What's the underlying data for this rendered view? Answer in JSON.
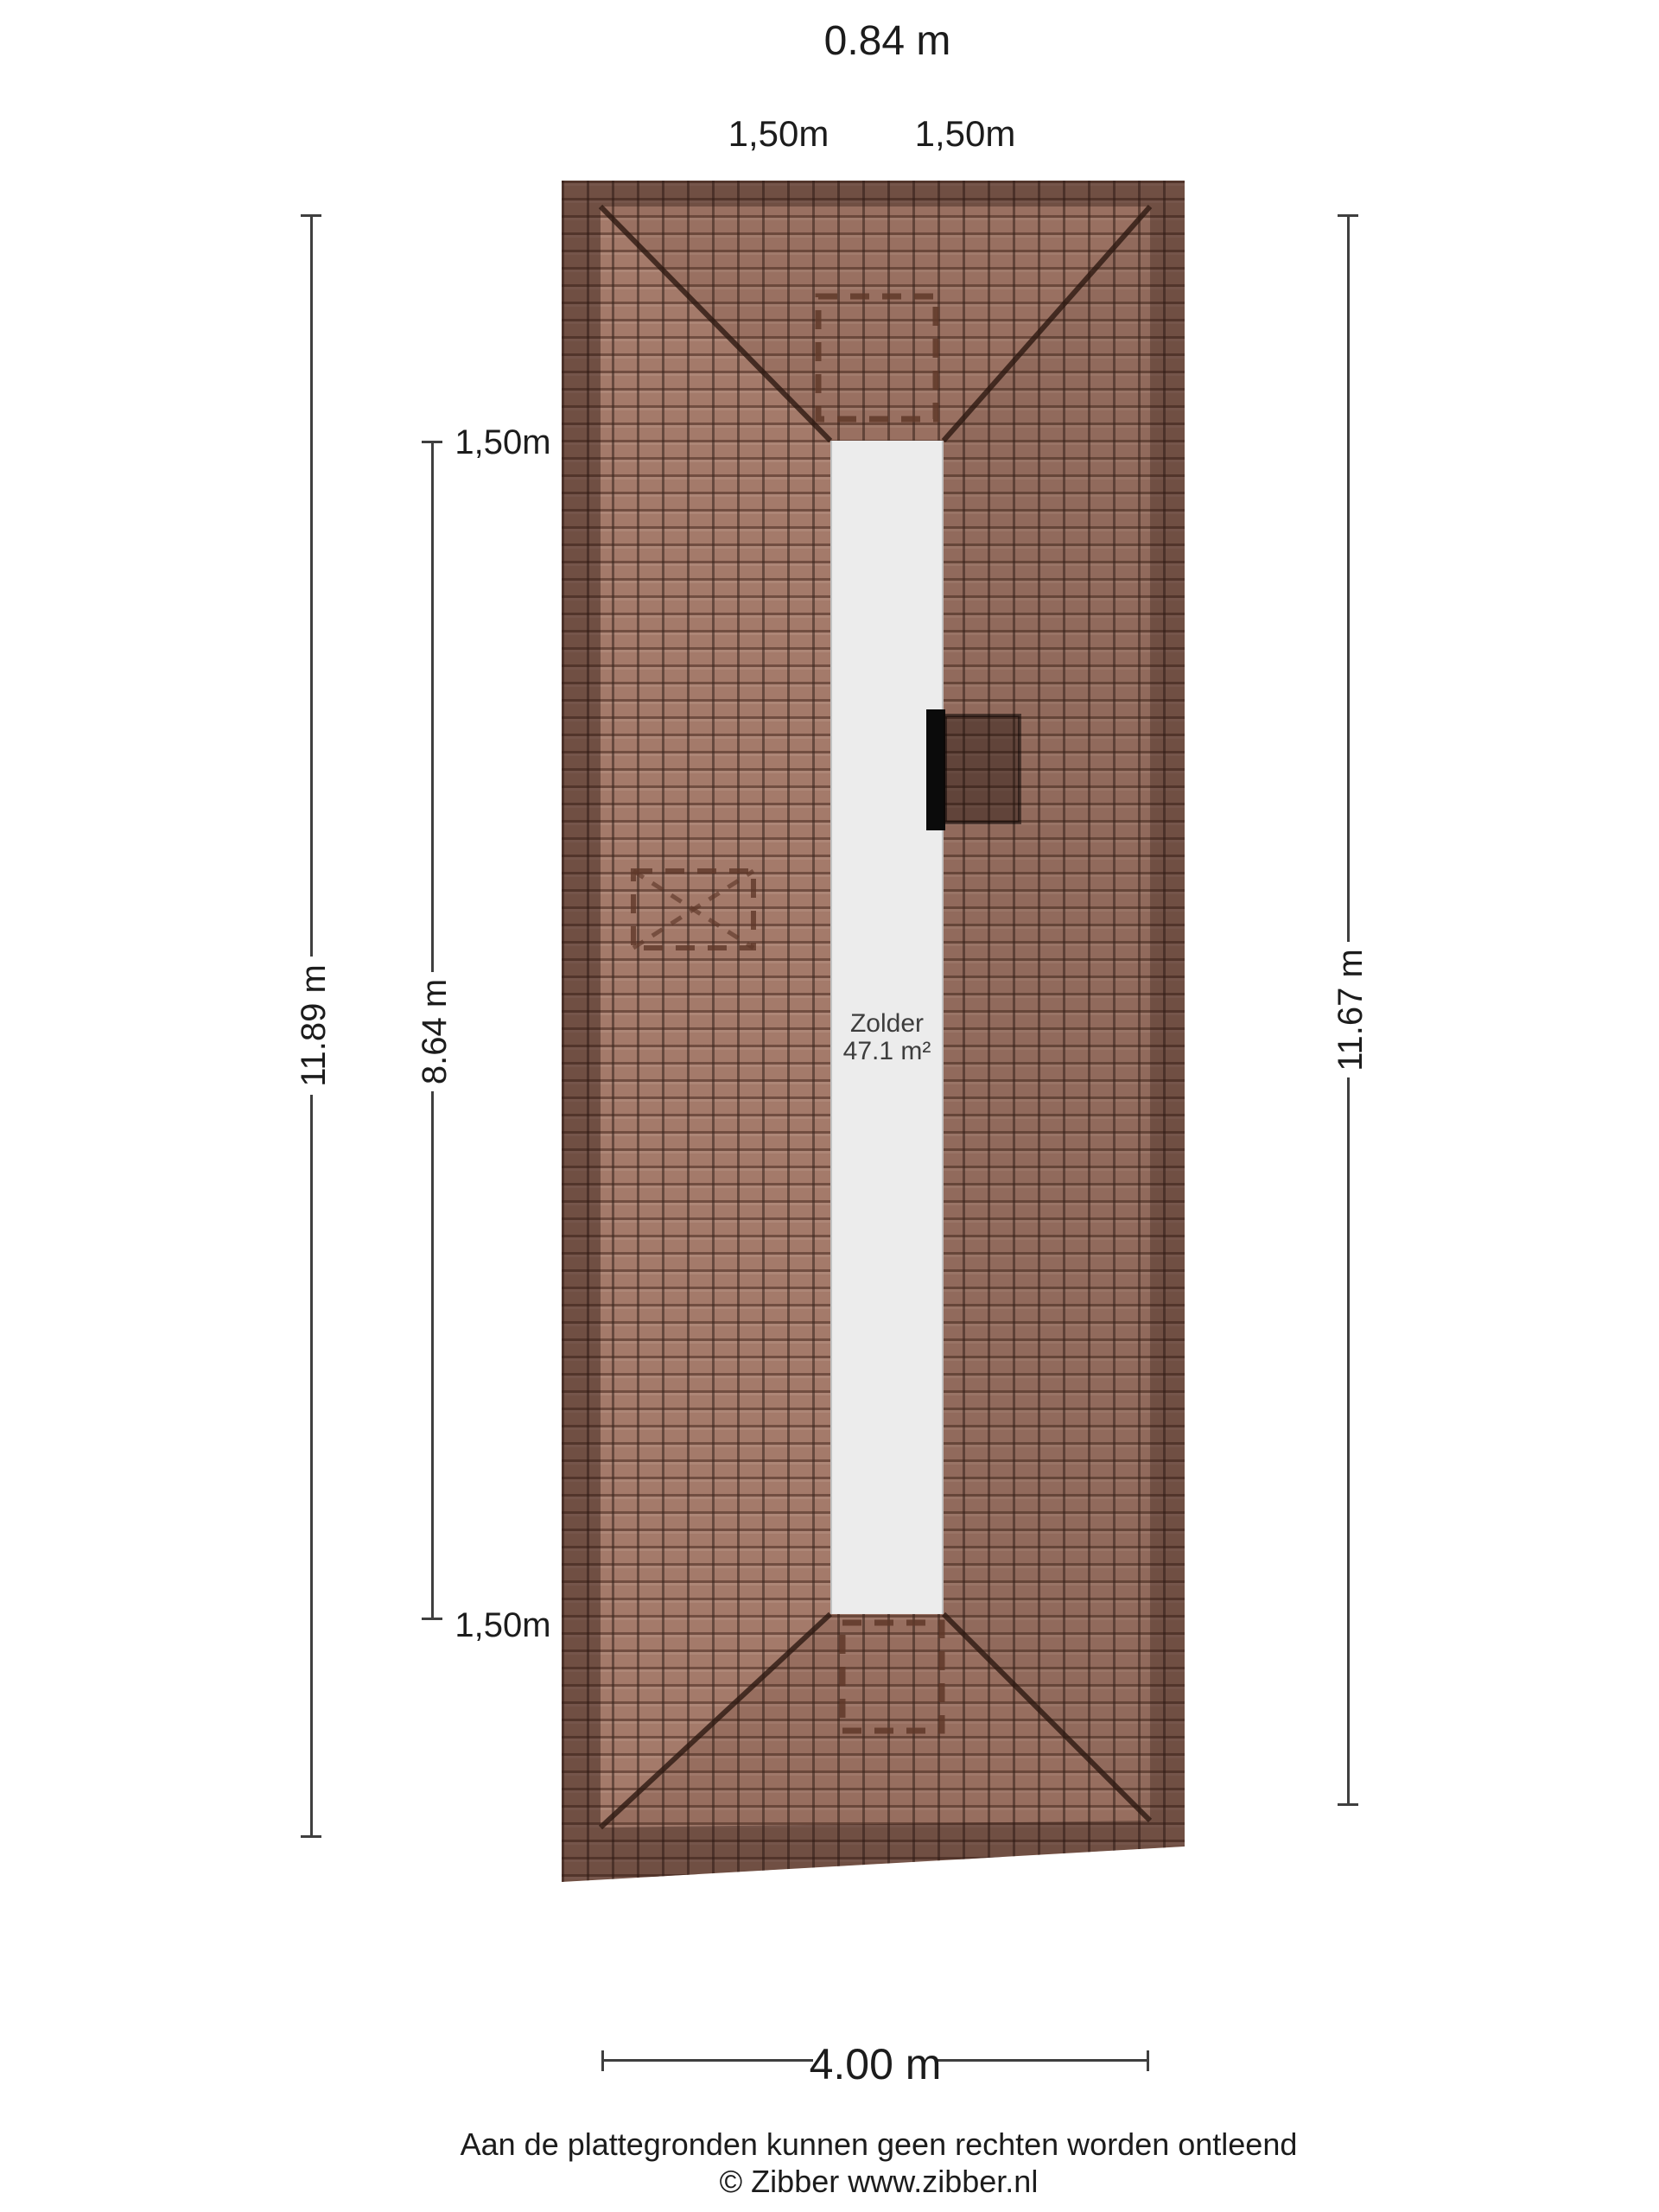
{
  "dimensions": {
    "roof_width_top": "0.84 m",
    "offset_top_left": "1,50m",
    "offset_top_right": "1,50m",
    "total_height_left": "11.89 m",
    "inner_height": "8.64 m",
    "inner_offset_top": "1,50m",
    "inner_offset_bottom": "1,50m",
    "total_height_right": "11.67 m",
    "total_width_bottom": "4.00 m"
  },
  "room": {
    "name": "Zolder",
    "area": "47.1 m²"
  },
  "footer": {
    "disclaimer": "Aan de plattegronden kunnen geen rechten worden ontleend",
    "copyright": "© Zibber www.zibber.nl"
  },
  "colors": {
    "tile_field": "#a47a6a",
    "tile_edge_band": "rgba(40,20,14,0.42)",
    "floor_strip": "#ececec",
    "dashed_outline": "#5f3829",
    "dimension_line": "#3f3f3f",
    "window_black": "#0b0b0b",
    "hip_line": "rgba(45,25,18,0.8)"
  }
}
